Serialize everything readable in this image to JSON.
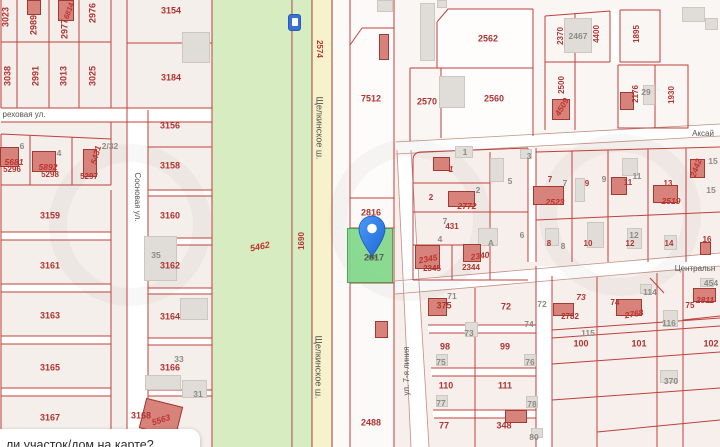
{
  "colors": {
    "parcel_line": "#c0403e",
    "red_number": "#b03431",
    "gray_number": "#8e8b86",
    "street_text": "#55524e",
    "green_field": "#d8ecc2",
    "road_yellow": "#f8f2cc",
    "road_edge": "#9c4a36",
    "selected_green": "#82d88b",
    "selected_border": "#3fa14d",
    "pin_blue": "#2f7fe8",
    "sign_blue": "#3a70d6",
    "building_red": "#d8827c",
    "building_gray": "#e0ddd8"
  },
  "tooltip": {
    "text": "ли участок/дом на карте?"
  },
  "selected_parcel": {
    "number": "2817"
  },
  "roads": {
    "highway": "Щелкинское ш.",
    "street_orekhovaya": "реховая ул.",
    "street_sosnovaya": "Сосновая ул.",
    "street_aksay": "Аксай",
    "street_central": "Центральн",
    "street_7line": "ул. 7-я линия"
  },
  "map": {
    "labels": [
      {
        "t": "3023",
        "x": 6,
        "y": 17,
        "k": "red",
        "r": -90
      },
      {
        "t": "2989",
        "x": 34,
        "y": 25,
        "k": "red",
        "r": -90
      },
      {
        "t": "6814",
        "x": 69,
        "y": 11,
        "k": "redi",
        "r": -70,
        "fs": 7.5
      },
      {
        "t": "2977",
        "x": 65,
        "y": 29,
        "k": "red",
        "r": -90
      },
      {
        "t": "2976",
        "x": 93,
        "y": 13,
        "k": "red",
        "r": -90
      },
      {
        "t": "3038",
        "x": 8,
        "y": 76,
        "k": "red",
        "r": -90
      },
      {
        "t": "2991",
        "x": 36,
        "y": 76,
        "k": "red",
        "r": -90
      },
      {
        "t": "3013",
        "x": 64,
        "y": 76,
        "k": "red",
        "r": -90
      },
      {
        "t": "3025",
        "x": 93,
        "y": 76,
        "k": "red",
        "r": -90
      },
      {
        "t": "реховая ул.",
        "x": 24,
        "y": 115,
        "k": "street",
        "n": "street-label-orekhovaya"
      },
      {
        "t": "6",
        "x": 22,
        "y": 146,
        "k": "gray"
      },
      {
        "t": "5681",
        "x": 14,
        "y": 162,
        "k": "redi"
      },
      {
        "t": "5296",
        "x": 12,
        "y": 170,
        "k": "red",
        "fs": 8
      },
      {
        "t": "4",
        "x": 59,
        "y": 153,
        "k": "gray"
      },
      {
        "t": "5892",
        "x": 48,
        "y": 167,
        "k": "redi"
      },
      {
        "t": "5298",
        "x": 50,
        "y": 175,
        "k": "red",
        "fs": 8
      },
      {
        "t": "5431",
        "x": 96,
        "y": 155,
        "k": "redi",
        "r": -75
      },
      {
        "t": "5297",
        "x": 89,
        "y": 177,
        "k": "red",
        "fs": 8
      },
      {
        "t": "2/32",
        "x": 110,
        "y": 146,
        "k": "gray"
      },
      {
        "t": "3159",
        "x": 50,
        "y": 216,
        "k": "red"
      },
      {
        "t": "3161",
        "x": 50,
        "y": 266,
        "k": "red"
      },
      {
        "t": "3163",
        "x": 50,
        "y": 316,
        "k": "red"
      },
      {
        "t": "3165",
        "x": 50,
        "y": 368,
        "k": "red"
      },
      {
        "t": "3167",
        "x": 50,
        "y": 418,
        "k": "red"
      },
      {
        "t": "Сосновая ул.",
        "x": 137,
        "y": 197,
        "k": "street",
        "r": 90,
        "n": "street-label-sosnovaya"
      },
      {
        "t": "3154",
        "x": 171,
        "y": 11,
        "k": "red"
      },
      {
        "t": "3184",
        "x": 171,
        "y": 78,
        "k": "red"
      },
      {
        "t": "3156",
        "x": 170,
        "y": 126,
        "k": "red"
      },
      {
        "t": "3158",
        "x": 170,
        "y": 166,
        "k": "red"
      },
      {
        "t": "3160",
        "x": 170,
        "y": 216,
        "k": "red"
      },
      {
        "t": "35",
        "x": 156,
        "y": 255,
        "k": "gray"
      },
      {
        "t": "3162",
        "x": 170,
        "y": 266,
        "k": "red"
      },
      {
        "t": "3164",
        "x": 170,
        "y": 317,
        "k": "red"
      },
      {
        "t": "33",
        "x": 179,
        "y": 359,
        "k": "gray"
      },
      {
        "t": "3166",
        "x": 170,
        "y": 368,
        "k": "red"
      },
      {
        "t": "31",
        "x": 198,
        "y": 394,
        "k": "gray"
      },
      {
        "t": "3168",
        "x": 141,
        "y": 416,
        "k": "red"
      },
      {
        "t": "5563",
        "x": 161,
        "y": 420,
        "k": "redi",
        "r": -18
      },
      {
        "t": "5462",
        "x": 260,
        "y": 247,
        "k": "redi",
        "r": -12,
        "fs": 9
      },
      {
        "t": "1690",
        "x": 302,
        "y": 241,
        "k": "red",
        "r": -90,
        "fs": 8
      },
      {
        "t": "2574",
        "x": 319,
        "y": 49,
        "k": "red",
        "r": 90,
        "fs": 8
      },
      {
        "t": "Щелкинское ш.",
        "x": 319,
        "y": 128,
        "k": "street",
        "r": 90,
        "fs": 9,
        "n": "road-label-shchelkinskoe-top"
      },
      {
        "t": "Щелкинское ш.",
        "x": 318,
        "y": 367,
        "k": "street",
        "r": 90,
        "fs": 9,
        "n": "road-label-shchelkinskoe-bottom"
      },
      {
        "t": "7512",
        "x": 371,
        "y": 99,
        "k": "red"
      },
      {
        "t": "2816",
        "x": 371,
        "y": 213,
        "k": "red"
      },
      {
        "t": "2817",
        "x": 374,
        "y": 258,
        "k": "dark",
        "n": "selected-parcel-number"
      },
      {
        "t": "2488",
        "x": 371,
        "y": 423,
        "k": "red"
      },
      {
        "t": "2570",
        "x": 427,
        "y": 102,
        "k": "red"
      },
      {
        "t": "2562",
        "x": 488,
        "y": 39,
        "k": "red"
      },
      {
        "t": "2560",
        "x": 494,
        "y": 99,
        "k": "red"
      },
      {
        "t": "2370",
        "x": 561,
        "y": 36,
        "k": "red",
        "r": -90,
        "fs": 8
      },
      {
        "t": "2467",
        "x": 578,
        "y": 36,
        "k": "gray"
      },
      {
        "t": "4400",
        "x": 597,
        "y": 34,
        "k": "red",
        "r": -90,
        "fs": 8
      },
      {
        "t": "1895",
        "x": 637,
        "y": 34,
        "k": "red",
        "r": -90,
        "fs": 8
      },
      {
        "t": "2500",
        "x": 562,
        "y": 85,
        "k": "red",
        "r": -90,
        "fs": 8
      },
      {
        "t": "4509",
        "x": 562,
        "y": 107,
        "k": "redi",
        "r": -60
      },
      {
        "t": "Аксай",
        "x": 703,
        "y": 134,
        "k": "street",
        "n": "street-label-aksay"
      },
      {
        "t": "2176",
        "x": 636,
        "y": 94,
        "k": "red",
        "r": -90,
        "fs": 8
      },
      {
        "t": "29",
        "x": 646,
        "y": 92,
        "k": "gray"
      },
      {
        "t": "1930",
        "x": 672,
        "y": 95,
        "k": "red",
        "r": -90,
        "fs": 8
      },
      {
        "t": "1",
        "x": 465,
        "y": 152,
        "k": "gray"
      },
      {
        "t": "1",
        "x": 451,
        "y": 169,
        "k": "redi"
      },
      {
        "t": "2",
        "x": 478,
        "y": 190,
        "k": "gray"
      },
      {
        "t": "2",
        "x": 431,
        "y": 198,
        "k": "red",
        "fs": 8
      },
      {
        "t": "2772",
        "x": 467,
        "y": 206,
        "k": "redi"
      },
      {
        "t": "3",
        "x": 529,
        "y": 156,
        "k": "gray"
      },
      {
        "t": "5",
        "x": 510,
        "y": 181,
        "k": "gray"
      },
      {
        "t": "7",
        "x": 445,
        "y": 221,
        "k": "gray"
      },
      {
        "t": "431",
        "x": 452,
        "y": 227,
        "k": "red",
        "fs": 8
      },
      {
        "t": "6",
        "x": 522,
        "y": 235,
        "k": "gray"
      },
      {
        "t": "7",
        "x": 550,
        "y": 180,
        "k": "red",
        "fs": 8
      },
      {
        "t": "7",
        "x": 565,
        "y": 183,
        "k": "gray"
      },
      {
        "t": "2523",
        "x": 555,
        "y": 202,
        "k": "redi"
      },
      {
        "t": "8",
        "x": 549,
        "y": 244,
        "k": "red",
        "fs": 8
      },
      {
        "t": "8",
        "x": 563,
        "y": 246,
        "k": "gray"
      },
      {
        "t": "9",
        "x": 587,
        "y": 184,
        "k": "red",
        "fs": 8
      },
      {
        "t": "9",
        "x": 604,
        "y": 179,
        "k": "gray"
      },
      {
        "t": "11",
        "x": 628,
        "y": 183,
        "k": "red",
        "fs": 8
      },
      {
        "t": "11",
        "x": 637,
        "y": 176,
        "k": "gray"
      },
      {
        "t": "13",
        "x": 668,
        "y": 184,
        "k": "red",
        "fs": 8
      },
      {
        "t": "2519",
        "x": 671,
        "y": 201,
        "k": "redi"
      },
      {
        "t": "2442",
        "x": 696,
        "y": 168,
        "k": "redi",
        "r": -70
      },
      {
        "t": "15",
        "x": 713,
        "y": 161,
        "k": "gray"
      },
      {
        "t": "15",
        "x": 711,
        "y": 190,
        "k": "gray"
      },
      {
        "t": "10",
        "x": 588,
        "y": 244,
        "k": "red",
        "fs": 8
      },
      {
        "t": "12",
        "x": 630,
        "y": 244,
        "k": "red",
        "fs": 8
      },
      {
        "t": "12",
        "x": 634,
        "y": 235,
        "k": "gray"
      },
      {
        "t": "14",
        "x": 669,
        "y": 244,
        "k": "red",
        "fs": 8
      },
      {
        "t": "16",
        "x": 707,
        "y": 240,
        "k": "red",
        "fs": 8
      },
      {
        "t": "4",
        "x": 440,
        "y": 239,
        "k": "gray"
      },
      {
        "t": "А",
        "x": 491,
        "y": 243,
        "k": "gray"
      },
      {
        "t": "2345",
        "x": 428,
        "y": 259,
        "k": "redi",
        "r": -10
      },
      {
        "t": "2345",
        "x": 432,
        "y": 269,
        "k": "red",
        "fs": 8
      },
      {
        "t": "2340",
        "x": 480,
        "y": 256,
        "k": "redi",
        "r": -8
      },
      {
        "t": "2344",
        "x": 471,
        "y": 268,
        "k": "red",
        "fs": 8
      },
      {
        "t": "Центральн",
        "x": 695,
        "y": 269,
        "k": "street",
        "n": "street-label-central"
      },
      {
        "t": "ул. 7-я линия",
        "x": 407,
        "y": 371,
        "k": "street",
        "r": -90,
        "n": "street-label-7line"
      },
      {
        "t": "71",
        "x": 452,
        "y": 296,
        "k": "gray"
      },
      {
        "t": "375",
        "x": 444,
        "y": 306,
        "k": "red"
      },
      {
        "t": "72",
        "x": 506,
        "y": 307,
        "k": "red"
      },
      {
        "t": "72",
        "x": 542,
        "y": 304,
        "k": "gray"
      },
      {
        "t": "74",
        "x": 529,
        "y": 324,
        "k": "gray"
      },
      {
        "t": "73",
        "x": 469,
        "y": 333,
        "k": "gray"
      },
      {
        "t": "98",
        "x": 445,
        "y": 347,
        "k": "red"
      },
      {
        "t": "99",
        "x": 505,
        "y": 347,
        "k": "red"
      },
      {
        "t": "75",
        "x": 441,
        "y": 362,
        "k": "gray"
      },
      {
        "t": "76",
        "x": 530,
        "y": 362,
        "k": "gray"
      },
      {
        "t": "110",
        "x": 446,
        "y": 386,
        "k": "red"
      },
      {
        "t": "111",
        "x": 505,
        "y": 386,
        "k": "red"
      },
      {
        "t": "77",
        "x": 441,
        "y": 403,
        "k": "gray"
      },
      {
        "t": "78",
        "x": 532,
        "y": 404,
        "k": "gray"
      },
      {
        "t": "77",
        "x": 444,
        "y": 426,
        "k": "red"
      },
      {
        "t": "348",
        "x": 504,
        "y": 426,
        "k": "red"
      },
      {
        "t": "80",
        "x": 534,
        "y": 437,
        "k": "gray"
      },
      {
        "t": "73",
        "x": 581,
        "y": 297,
        "k": "redi"
      },
      {
        "t": "2782",
        "x": 570,
        "y": 317,
        "k": "red",
        "fs": 8
      },
      {
        "t": "114",
        "x": 650,
        "y": 292,
        "k": "gray"
      },
      {
        "t": "74",
        "x": 615,
        "y": 303,
        "k": "red",
        "fs": 8
      },
      {
        "t": "2768",
        "x": 634,
        "y": 314,
        "k": "redi",
        "r": -10
      },
      {
        "t": "116",
        "x": 669,
        "y": 323,
        "k": "gray"
      },
      {
        "t": "75",
        "x": 690,
        "y": 306,
        "k": "red",
        "fs": 8
      },
      {
        "t": "2811",
        "x": 705,
        "y": 300,
        "k": "redi"
      },
      {
        "t": "454",
        "x": 711,
        "y": 283,
        "k": "gray"
      },
      {
        "t": "115",
        "x": 588,
        "y": 333,
        "k": "gray"
      },
      {
        "t": "100",
        "x": 581,
        "y": 344,
        "k": "red"
      },
      {
        "t": "101",
        "x": 639,
        "y": 344,
        "k": "red"
      },
      {
        "t": "102",
        "x": 711,
        "y": 344,
        "k": "red"
      },
      {
        "t": "370",
        "x": 671,
        "y": 381,
        "k": "gray"
      }
    ],
    "buildings": [
      {
        "x": 27,
        "y": 0,
        "w": 14,
        "h": 15,
        "k": "r"
      },
      {
        "x": 58,
        "y": 0,
        "w": 16,
        "h": 21,
        "k": "r"
      },
      {
        "x": 182,
        "y": 32,
        "w": 28,
        "h": 31,
        "k": "g"
      },
      {
        "x": 0,
        "y": 147,
        "w": 19,
        "h": 20,
        "k": "r"
      },
      {
        "x": 32,
        "y": 151,
        "w": 24,
        "h": 21,
        "k": "r"
      },
      {
        "x": 83,
        "y": 149,
        "w": 14,
        "h": 28,
        "k": "r"
      },
      {
        "x": 144,
        "y": 236,
        "w": 33,
        "h": 45,
        "k": "g"
      },
      {
        "x": 145,
        "y": 375,
        "w": 36,
        "h": 15,
        "k": "g"
      },
      {
        "x": 180,
        "y": 298,
        "w": 28,
        "h": 22,
        "k": "g"
      },
      {
        "x": 182,
        "y": 380,
        "w": 25,
        "h": 18,
        "k": "g"
      },
      {
        "x": 142,
        "y": 402,
        "w": 38,
        "h": 31,
        "k": "r",
        "rot": 14
      },
      {
        "x": 377,
        "y": 0,
        "w": 16,
        "h": 12,
        "k": "g"
      },
      {
        "x": 437,
        "y": 0,
        "w": 10,
        "h": 8,
        "k": "g"
      },
      {
        "x": 420,
        "y": 3,
        "w": 15,
        "h": 58,
        "k": "g"
      },
      {
        "x": 439,
        "y": 76,
        "w": 26,
        "h": 32,
        "k": "g"
      },
      {
        "x": 379,
        "y": 34,
        "w": 10,
        "h": 26,
        "k": "r"
      },
      {
        "x": 375,
        "y": 321,
        "w": 13,
        "h": 17,
        "k": "r"
      },
      {
        "x": 564,
        "y": 18,
        "w": 28,
        "h": 35,
        "k": "g"
      },
      {
        "x": 682,
        "y": 7,
        "w": 23,
        "h": 15,
        "k": "g"
      },
      {
        "x": 705,
        "y": 18,
        "w": 13,
        "h": 12,
        "k": "g"
      },
      {
        "x": 552,
        "y": 99,
        "w": 18,
        "h": 21,
        "k": "r"
      },
      {
        "x": 643,
        "y": 85,
        "w": 12,
        "h": 20,
        "k": "g"
      },
      {
        "x": 620,
        "y": 92,
        "w": 14,
        "h": 18,
        "k": "r"
      },
      {
        "x": 455,
        "y": 146,
        "w": 18,
        "h": 12,
        "k": "g"
      },
      {
        "x": 490,
        "y": 158,
        "w": 14,
        "h": 24,
        "k": "g"
      },
      {
        "x": 520,
        "y": 149,
        "w": 12,
        "h": 10,
        "k": "g"
      },
      {
        "x": 433,
        "y": 157,
        "w": 17,
        "h": 14,
        "k": "r"
      },
      {
        "x": 448,
        "y": 191,
        "w": 27,
        "h": 16,
        "k": "r"
      },
      {
        "x": 533,
        "y": 186,
        "w": 31,
        "h": 19,
        "k": "r"
      },
      {
        "x": 611,
        "y": 177,
        "w": 16,
        "h": 18,
        "k": "r"
      },
      {
        "x": 653,
        "y": 185,
        "w": 25,
        "h": 18,
        "k": "r"
      },
      {
        "x": 690,
        "y": 159,
        "w": 15,
        "h": 19,
        "k": "r"
      },
      {
        "x": 575,
        "y": 178,
        "w": 10,
        "h": 24,
        "k": "g"
      },
      {
        "x": 622,
        "y": 158,
        "w": 16,
        "h": 18,
        "k": "g"
      },
      {
        "x": 587,
        "y": 222,
        "w": 17,
        "h": 26,
        "k": "g"
      },
      {
        "x": 627,
        "y": 228,
        "w": 15,
        "h": 21,
        "k": "g"
      },
      {
        "x": 664,
        "y": 235,
        "w": 13,
        "h": 15,
        "k": "g"
      },
      {
        "x": 478,
        "y": 228,
        "w": 20,
        "h": 18,
        "k": "g"
      },
      {
        "x": 545,
        "y": 228,
        "w": 14,
        "h": 18,
        "k": "g"
      },
      {
        "x": 415,
        "y": 245,
        "w": 25,
        "h": 24,
        "k": "r"
      },
      {
        "x": 463,
        "y": 244,
        "w": 18,
        "h": 18,
        "k": "r"
      },
      {
        "x": 700,
        "y": 242,
        "w": 11,
        "h": 13,
        "k": "r"
      },
      {
        "x": 428,
        "y": 298,
        "w": 19,
        "h": 18,
        "k": "r"
      },
      {
        "x": 465,
        "y": 322,
        "w": 13,
        "h": 15,
        "k": "g"
      },
      {
        "x": 436,
        "y": 354,
        "w": 12,
        "h": 12,
        "k": "g"
      },
      {
        "x": 524,
        "y": 354,
        "w": 12,
        "h": 12,
        "k": "g"
      },
      {
        "x": 436,
        "y": 395,
        "w": 12,
        "h": 12,
        "k": "g"
      },
      {
        "x": 526,
        "y": 396,
        "w": 12,
        "h": 12,
        "k": "g"
      },
      {
        "x": 505,
        "y": 410,
        "w": 22,
        "h": 13,
        "k": "r"
      },
      {
        "x": 531,
        "y": 428,
        "w": 12,
        "h": 10,
        "k": "g"
      },
      {
        "x": 553,
        "y": 303,
        "w": 21,
        "h": 13,
        "k": "r"
      },
      {
        "x": 616,
        "y": 299,
        "w": 26,
        "h": 17,
        "k": "r"
      },
      {
        "x": 693,
        "y": 288,
        "w": 23,
        "h": 14,
        "k": "r"
      },
      {
        "x": 700,
        "y": 278,
        "w": 14,
        "h": 9,
        "k": "g"
      },
      {
        "x": 663,
        "y": 310,
        "w": 15,
        "h": 17,
        "k": "g"
      },
      {
        "x": 640,
        "y": 284,
        "w": 12,
        "h": 10,
        "k": "g"
      },
      {
        "x": 660,
        "y": 370,
        "w": 18,
        "h": 13,
        "k": "g"
      }
    ]
  }
}
